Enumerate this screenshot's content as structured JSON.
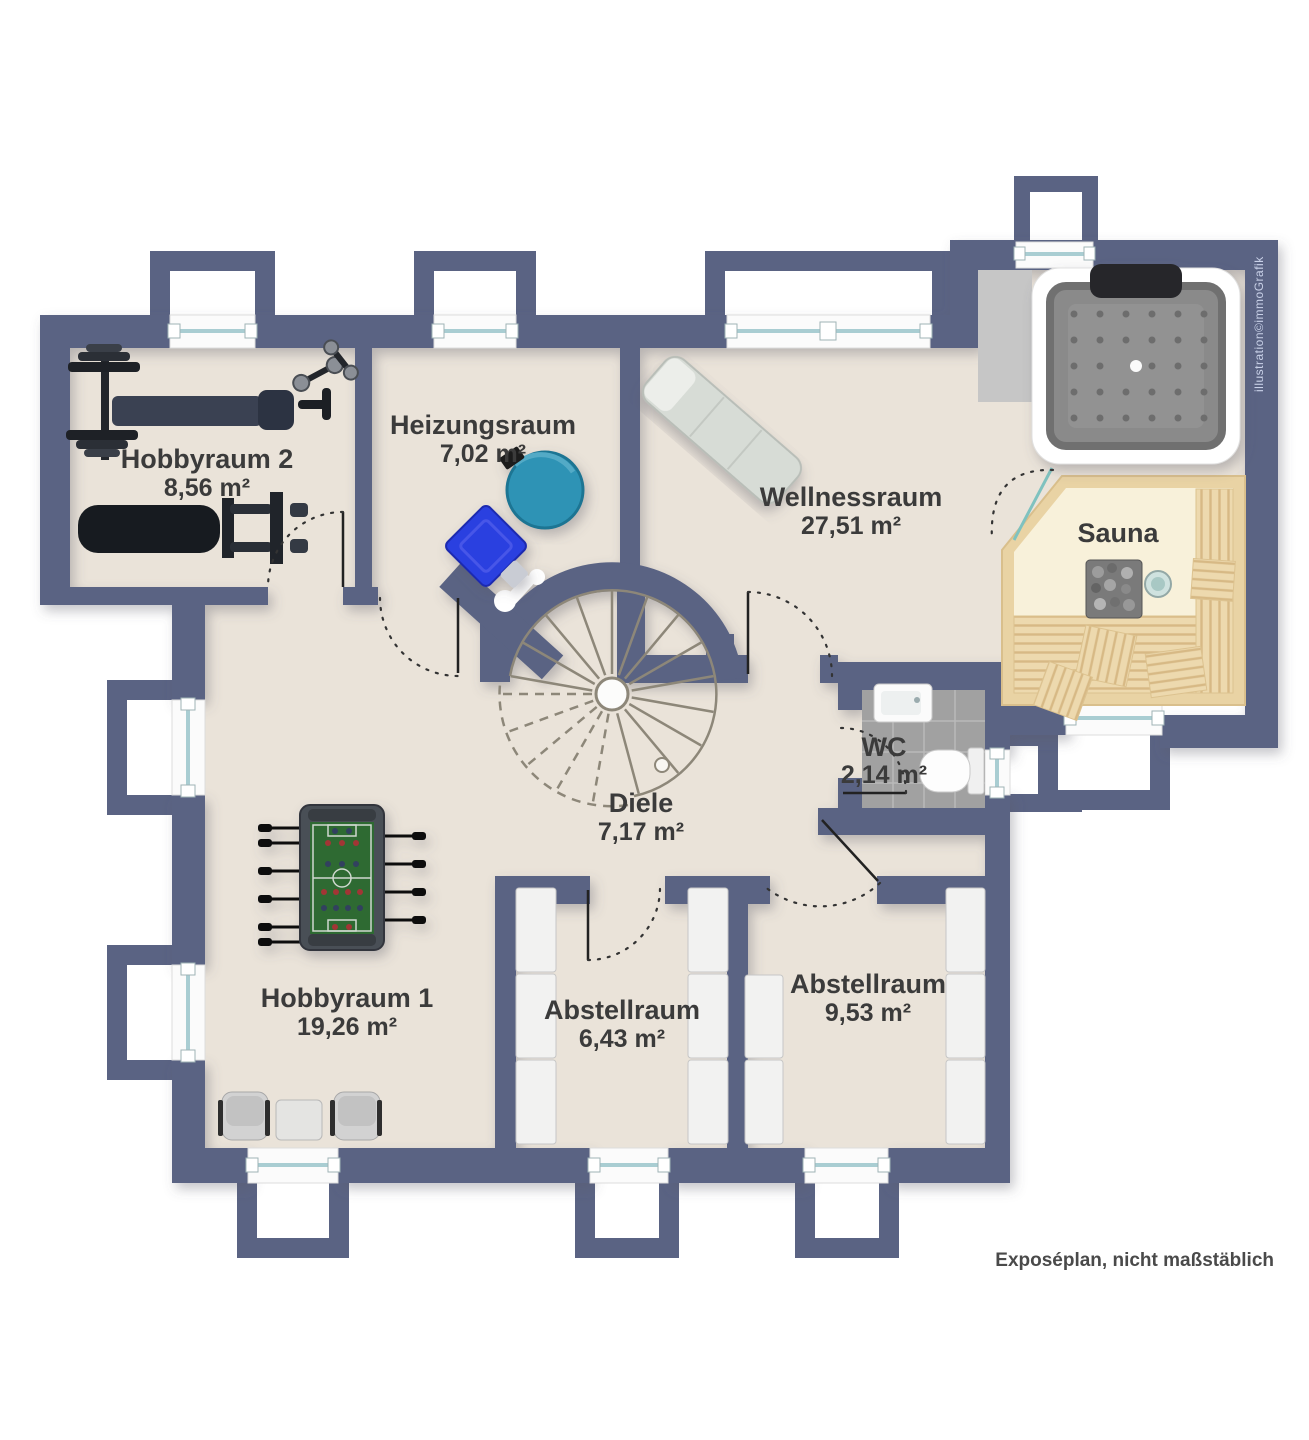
{
  "plan": {
    "rooms": [
      {
        "id": "hobbyraum-2",
        "name": "Hobbyraum 2",
        "area": "8,56 m²"
      },
      {
        "id": "heizungsraum",
        "name": "Heizungsraum",
        "area": "7,02 m²"
      },
      {
        "id": "wellnessraum",
        "name": "Wellnessraum",
        "area": "27,51 m²"
      },
      {
        "id": "sauna",
        "name": "Sauna"
      },
      {
        "id": "wc",
        "name": "WC",
        "area": "2,14 m²"
      },
      {
        "id": "diele",
        "name": "Diele",
        "area": "7,17 m²"
      },
      {
        "id": "hobbyraum-1",
        "name": "Hobbyraum 1",
        "area": "19,26 m²"
      },
      {
        "id": "abstellraum-1",
        "name": "Abstellraum",
        "area": "6,43 m²"
      },
      {
        "id": "abstellraum-2",
        "name": "Abstellraum",
        "area": "9,53 m²"
      }
    ],
    "notes": {
      "disclaimer": "Exposéplan, nicht maßstäblich",
      "credit": "illustration©immoGrafik"
    },
    "colors": {
      "wall": "#5a6383",
      "floor": "#eae3d9",
      "sauna_wood": "#e9d3a4",
      "sauna_floor": "#f8f1da",
      "wc_tile": "#a1a1a1",
      "window_glass": "#a9cdd2",
      "boiler_teal": "#2d93b5",
      "heater_blue": "#2c3ce3",
      "foosball_green": "#2e6b30",
      "label_text": "#3b3b3b",
      "credit_text": "#c9d1e8"
    }
  }
}
